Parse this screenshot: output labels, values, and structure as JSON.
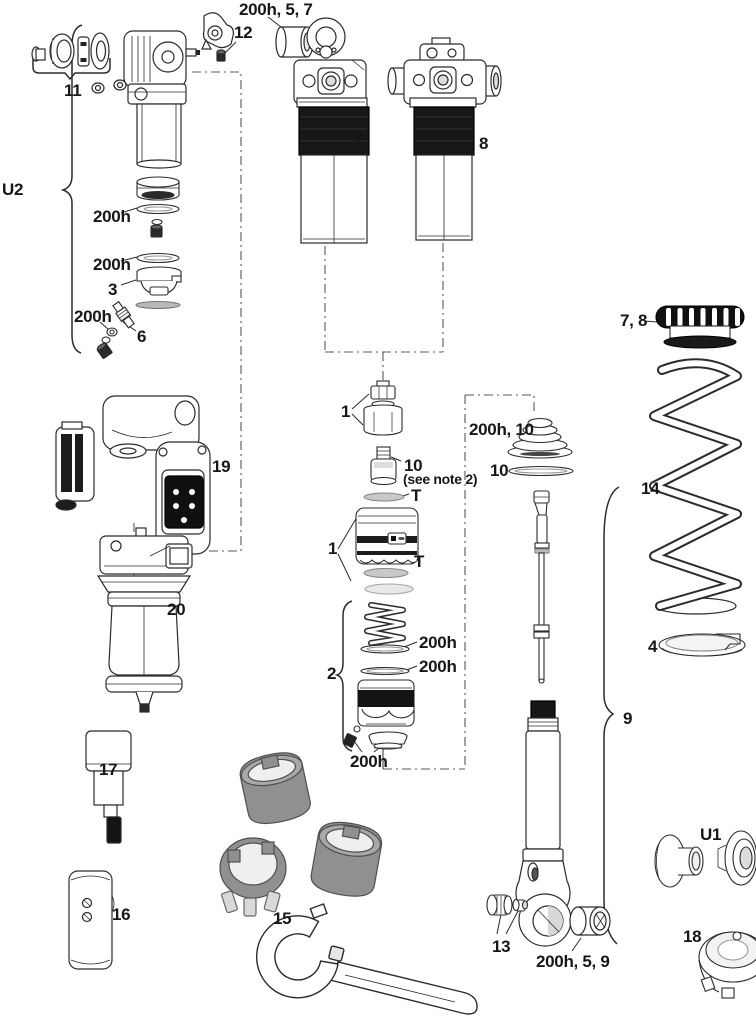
{
  "figure": {
    "kind": "exploded-parts-diagram",
    "background": "#ffffff",
    "ink": "#2b2b2b",
    "dark_fill": "#161616",
    "grey_sleeve": "#909090",
    "light_grey": "#cccccc",
    "dash_line": "#5a5a5a"
  },
  "callouts": [
    {
      "id": "200h-5-7",
      "text": "200h, 5, 7",
      "x": 239,
      "y": 1
    },
    {
      "id": "12",
      "text": "12",
      "x": 234,
      "y": 24
    },
    {
      "id": "11",
      "text": "11",
      "x": 64,
      "y": 82
    },
    {
      "id": "u2",
      "text": "U2",
      "x": 2,
      "y": 181
    },
    {
      "id": "200h-a",
      "text": "200h",
      "x": 93,
      "y": 208
    },
    {
      "id": "200h-b",
      "text": "200h",
      "x": 93,
      "y": 256
    },
    {
      "id": "3",
      "text": "3",
      "x": 108,
      "y": 281
    },
    {
      "id": "200h-c",
      "text": "200h",
      "x": 74,
      "y": 308
    },
    {
      "id": "6",
      "text": "6",
      "x": 137,
      "y": 328
    },
    {
      "id": "7",
      "text": "7",
      "x": 354,
      "y": 132
    },
    {
      "id": "8",
      "text": "8",
      "x": 479,
      "y": 135
    },
    {
      "id": "7-8",
      "text": "7, 8",
      "x": 620,
      "y": 312
    },
    {
      "id": "14",
      "text": "14",
      "x": 641,
      "y": 480
    },
    {
      "id": "1-upper",
      "text": "1",
      "x": 341,
      "y": 403
    },
    {
      "id": "10-mid",
      "text": "10",
      "x": 404,
      "y": 457
    },
    {
      "id": "note2",
      "text": "(see note 2)",
      "x": 403,
      "y": 472
    },
    {
      "id": "t-upper",
      "text": "T",
      "x": 411,
      "y": 487
    },
    {
      "id": "1-lower",
      "text": "1",
      "x": 328,
      "y": 540
    },
    {
      "id": "t-lower",
      "text": "T",
      "x": 414,
      "y": 553
    },
    {
      "id": "200h-10",
      "text": "200h, 10",
      "x": 469,
      "y": 421
    },
    {
      "id": "10-right",
      "text": "10",
      "x": 490,
      "y": 462
    },
    {
      "id": "2",
      "text": "2",
      "x": 327,
      "y": 665
    },
    {
      "id": "200h-d",
      "text": "200h",
      "x": 419,
      "y": 634
    },
    {
      "id": "200h-e",
      "text": "200h",
      "x": 419,
      "y": 658
    },
    {
      "id": "200h-f",
      "text": "200h",
      "x": 350,
      "y": 753
    },
    {
      "id": "19",
      "text": "19",
      "x": 212,
      "y": 458
    },
    {
      "id": "20",
      "text": "20",
      "x": 167,
      "y": 601
    },
    {
      "id": "9",
      "text": "9",
      "x": 623,
      "y": 710
    },
    {
      "id": "4",
      "text": "4",
      "x": 648,
      "y": 638
    },
    {
      "id": "17",
      "text": "17",
      "x": 99,
      "y": 761
    },
    {
      "id": "16",
      "text": "16",
      "x": 112,
      "y": 906
    },
    {
      "id": "15",
      "text": "15",
      "x": 273,
      "y": 910
    },
    {
      "id": "13",
      "text": "13",
      "x": 492,
      "y": 938
    },
    {
      "id": "200h-5-9",
      "text": "200h, 5, 9",
      "x": 536,
      "y": 953
    },
    {
      "id": "u1",
      "text": "U1",
      "x": 700,
      "y": 826
    },
    {
      "id": "18",
      "text": "18",
      "x": 683,
      "y": 928
    }
  ]
}
